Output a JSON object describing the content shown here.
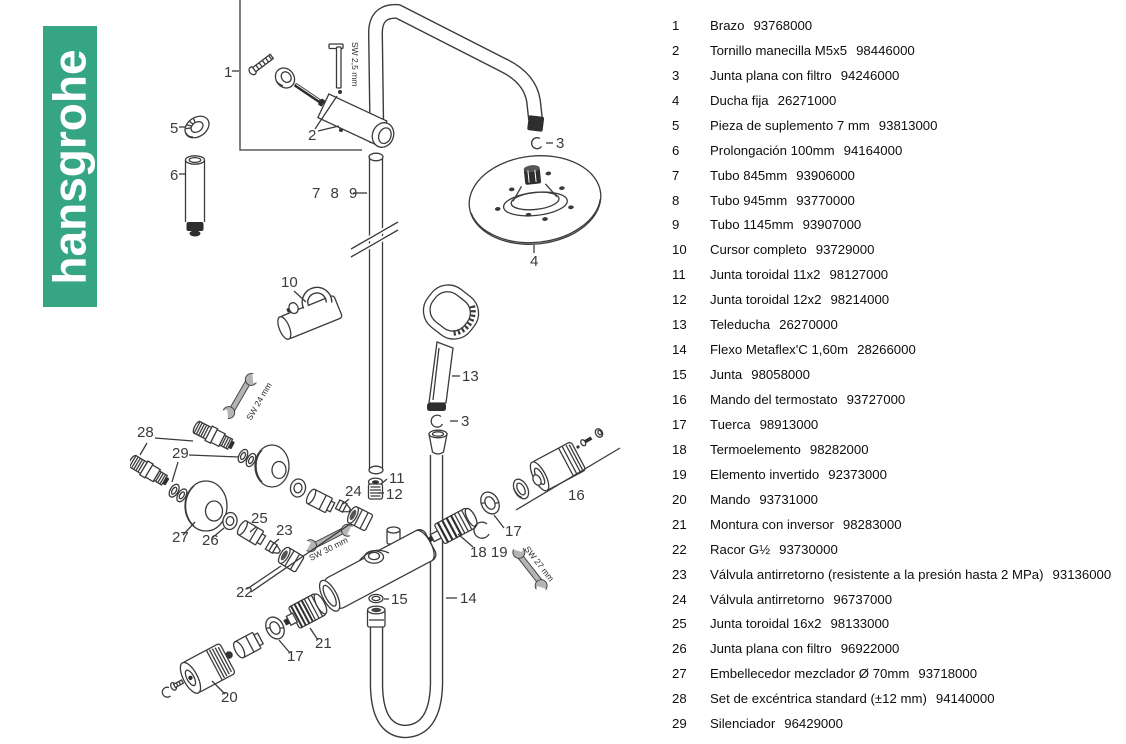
{
  "brand": {
    "logo_text": "hansgrohe",
    "logo_color": "#35a583"
  },
  "parts_list": {
    "items": [
      {
        "num": "1",
        "name": "Brazo",
        "code": "93768000"
      },
      {
        "num": "2",
        "name": "Tornillo manecilla M5x5",
        "code": "98446000"
      },
      {
        "num": "3",
        "name": "Junta plana con filtro",
        "code": "94246000"
      },
      {
        "num": "4",
        "name": "Ducha fija",
        "code": "26271000"
      },
      {
        "num": "5",
        "name": "Pieza de suplemento 7 mm",
        "code": "93813000"
      },
      {
        "num": "6",
        "name": "Prolongación 100mm",
        "code": "94164000"
      },
      {
        "num": "7",
        "name": "Tubo 845mm",
        "code": "93906000"
      },
      {
        "num": "8",
        "name": "Tubo 945mm",
        "code": "93770000"
      },
      {
        "num": "9",
        "name": "Tubo 1145mm",
        "code": "93907000"
      },
      {
        "num": "10",
        "name": "Cursor completo",
        "code": "93729000"
      },
      {
        "num": "11",
        "name": "Junta toroidal 11x2",
        "code": "98127000"
      },
      {
        "num": "12",
        "name": "Junta toroidal 12x2",
        "code": "98214000"
      },
      {
        "num": "13",
        "name": "Teleducha",
        "code": "26270000"
      },
      {
        "num": "14",
        "name": "Flexo Metaflex'C 1,60m",
        "code": "28266000"
      },
      {
        "num": "15",
        "name": "Junta",
        "code": "98058000"
      },
      {
        "num": "16",
        "name": "Mando del termostato",
        "code": "93727000"
      },
      {
        "num": "17",
        "name": "Tuerca",
        "code": "98913000"
      },
      {
        "num": "18",
        "name": "Termoelemento",
        "code": "98282000"
      },
      {
        "num": "19",
        "name": "Elemento invertido",
        "code": "92373000"
      },
      {
        "num": "20",
        "name": "Mando",
        "code": "93731000"
      },
      {
        "num": "21",
        "name": "Montura con inversor",
        "code": "98283000"
      },
      {
        "num": "22",
        "name": "Racor G½",
        "code": "93730000"
      },
      {
        "num": "23",
        "name": "Válvula antirretorno (resistente a la presión hasta 2 MPa)",
        "code": "93136000"
      },
      {
        "num": "24",
        "name": "Válvula antirretorno",
        "code": "96737000"
      },
      {
        "num": "25",
        "name": "Junta toroidal 16x2",
        "code": "98133000"
      },
      {
        "num": "26",
        "name": "Junta plana con filtro",
        "code": "96922000"
      },
      {
        "num": "27",
        "name": "Embellecedor mezclador Ø 70mm",
        "code": "93718000"
      },
      {
        "num": "28",
        "name": "Set de excéntrica standard (±12 mm)",
        "code": "94140000"
      },
      {
        "num": "29",
        "name": "Silenciador",
        "code": "96429000"
      }
    ]
  },
  "diagram": {
    "callouts": {
      "c1": "1",
      "c2": "2",
      "c3a": "3",
      "c3b": "3",
      "c4": "4",
      "c5": "5",
      "c6": "6",
      "c789": "7 8 9",
      "c10": "10",
      "c11": "11",
      "c12": "12",
      "c13": "13",
      "c14": "14",
      "c15": "15",
      "c16": "16",
      "c17a": "17",
      "c17b": "17",
      "c1819": "18 19",
      "c20": "20",
      "c21": "21",
      "c22": "22",
      "c23": "23",
      "c24": "24",
      "c25": "25",
      "c26": "26",
      "c27": "27",
      "c28": "28",
      "c29": "29"
    },
    "tool_labels": {
      "allen": "SW 2,5 mm",
      "sw24": "SW 24 mm",
      "sw30": "SW 30 mm",
      "sw27": "SW 27 mm"
    }
  }
}
